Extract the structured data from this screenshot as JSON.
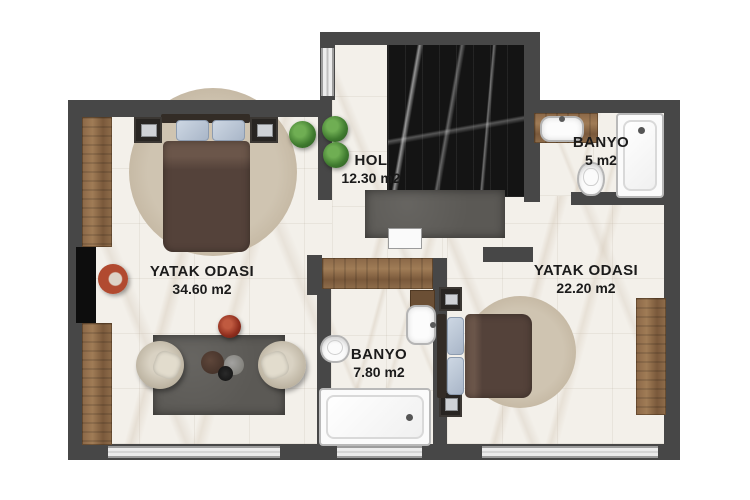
{
  "plan_title": "Apartment floor plan",
  "rooms": {
    "bedroom_left": {
      "name": "YATAK ODASI",
      "area": "34.60 m2"
    },
    "bedroom_right": {
      "name": "YATAK ODASI",
      "area": "22.20 m2"
    },
    "hall": {
      "name": "HOL",
      "area": "12.30 m2"
    },
    "bathroom_top": {
      "name": "BANYO",
      "area": "5 m2"
    },
    "bathroom_mid": {
      "name": "BANYO",
      "area": "7.80 m2"
    }
  },
  "colors": {
    "wall": "#474747",
    "floor": "#f3f0ea",
    "dark_marble": "#141414",
    "wood": "#8a6747",
    "label_text": "#1b1b1b",
    "rug_dark": "#5b5955",
    "rug_round": "#c4b7a2",
    "duvet": "#54423a",
    "pillow": "#b7c3d4",
    "accent_red": "#8e2d1d",
    "plant_green": "#3f7a2f"
  }
}
